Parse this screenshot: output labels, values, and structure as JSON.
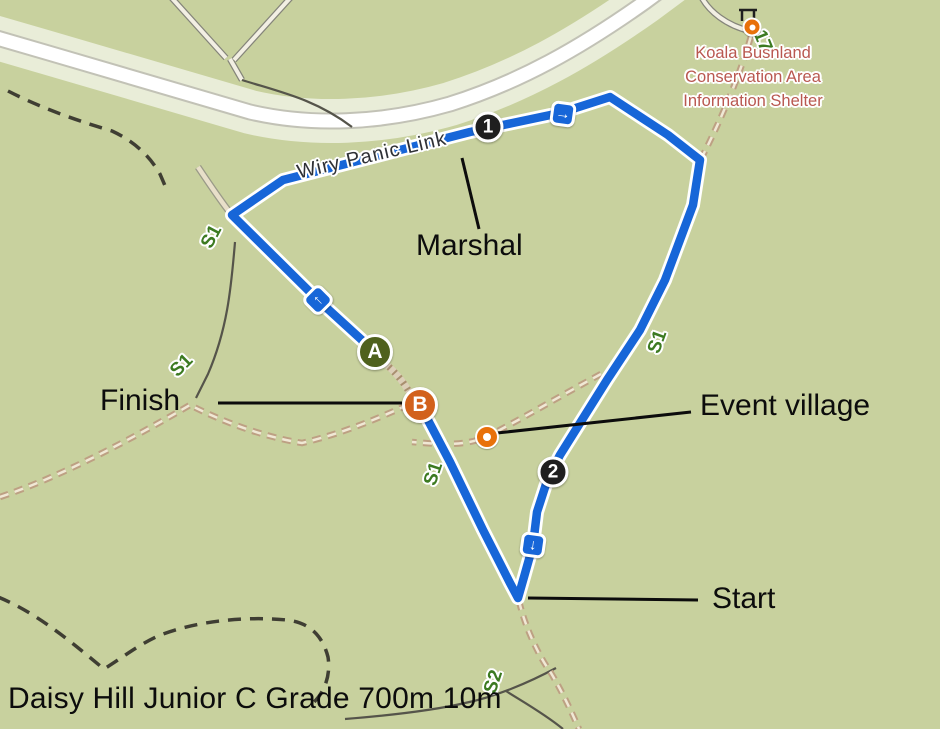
{
  "title": "Daisy Hill Junior C Grade 700m 10m",
  "annotations": {
    "marshal": "Marshal",
    "finish": "Finish",
    "event_village": "Event village",
    "start": "Start"
  },
  "poi_label": {
    "line1": "Koala Bushland",
    "line2": "Conservation Area",
    "line3": "Information Shelter"
  },
  "trail_name": "Wiry Panic Link",
  "trail_refs": {
    "s1_northwest": "S1",
    "s1_west": "S1",
    "s1_center": "S1",
    "s1_east": "S1",
    "s2_south": "S2",
    "ref_17": "17"
  },
  "route_markers": {
    "control_1": "1",
    "control_2": "2",
    "point_a": "A",
    "point_b": "B"
  },
  "direction_badges": {
    "up_left": "↑",
    "right": "→",
    "down": "↓"
  },
  "colors": {
    "map_background": "#c8d19e",
    "route_blue": "#1766d8",
    "road_white": "#ffffff",
    "road_halo": "#e9edd8",
    "control_black": "#1f1f1f",
    "marker_a_green": "#4f611d",
    "marker_b_orange": "#d2611c",
    "poi_orange": "#e8710a",
    "poi_text_red": "#b95850",
    "trail_ref_green": "#3c7a21",
    "trail_tan": "#bda083"
  }
}
